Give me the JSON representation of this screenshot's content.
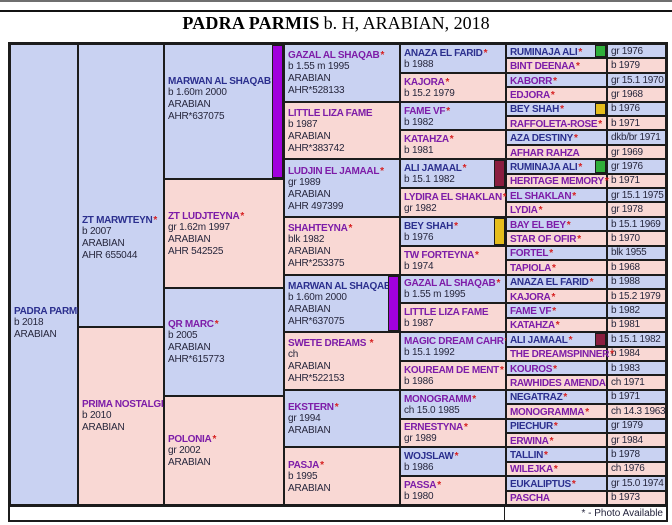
{
  "title": {
    "name": "PADRA PARMIS",
    "details": "b. H, ARABIAN, 2018"
  },
  "footer_note": "* - Photo Available",
  "star_char": "*",
  "colors": {
    "lavender": "#c9d2f2",
    "pink": "#f9d8d4",
    "link_blue": "#2b2f8e",
    "link_purple": "#7d1ca8",
    "star_red": "#d62020",
    "detail_text": "#26263c",
    "grid": "#1c1c1c",
    "ribbon_purple": "#a100dd",
    "ribbon_maroon": "#8a1e3f",
    "ribbon_yellow": "#e5bd1c",
    "ribbon_green": "#2fae3a"
  },
  "pedigree": {
    "gen1": [
      {
        "name": "PADRA PARMIS",
        "star": false,
        "link": "blue",
        "lines": [
          "b 2018",
          "ARABIAN"
        ],
        "ribbon": null
      }
    ],
    "gen2": [
      {
        "name": "ZT MARWTEYN",
        "star": true,
        "link": "blue",
        "lines": [
          "b 2007",
          "ARABIAN",
          "AHR 655044"
        ],
        "ribbon": null
      },
      {
        "name": "PRIMA NOSTALGIA",
        "star": false,
        "link": "purple",
        "lines": [
          "b 2010",
          "ARABIAN"
        ],
        "ribbon": null
      }
    ],
    "gen3": [
      {
        "name": "MARWAN AL SHAQAB",
        "star": true,
        "link": "blue",
        "lines": [
          "b 1.60m 2000",
          "ARABIAN",
          "AHR*637075"
        ],
        "ribbon": "purple"
      },
      {
        "name": "ZT LUDJTEYNA",
        "star": true,
        "link": "purple",
        "lines": [
          "gr 1.62m 1997",
          "ARABIAN",
          "AHR 542525"
        ],
        "ribbon": null
      },
      {
        "name": "QR MARC",
        "star": true,
        "link": "purple",
        "lines": [
          "b 2005",
          "ARABIAN",
          "AHR*615773"
        ],
        "ribbon": null
      },
      {
        "name": "POLONIA",
        "star": true,
        "link": "purple",
        "lines": [
          "gr 2002",
          "ARABIAN"
        ],
        "ribbon": null
      }
    ],
    "gen4": [
      {
        "name": "GAZAL AL SHAQAB",
        "star": true,
        "link": "purple",
        "lines": [
          "b 1.55 m 1995",
          "ARABIAN",
          "AHR*528133"
        ],
        "ribbon": null
      },
      {
        "name": "LITTLE LIZA FAME",
        "star": false,
        "link": "purple",
        "lines": [
          "b 1987",
          "ARABIAN",
          "AHR*383742"
        ],
        "ribbon": null
      },
      {
        "name": "LUDJIN EL JAMAAL",
        "star": true,
        "link": "purple",
        "lines": [
          "gr 1989",
          "ARABIAN",
          "AHR 497399"
        ],
        "ribbon": null
      },
      {
        "name": "SHAHTEYNA",
        "star": true,
        "link": "purple",
        "lines": [
          "blk 1982",
          "ARABIAN",
          "AHR*253375"
        ],
        "ribbon": null
      },
      {
        "name": "MARWAN AL SHAQAB",
        "star": true,
        "link": "blue",
        "lines": [
          "b 1.60m 2000",
          "ARABIAN",
          "AHR*637075"
        ],
        "ribbon": "purple"
      },
      {
        "name": "SWETE DREAMS ",
        "star": true,
        "link": "purple",
        "lines": [
          "ch",
          "ARABIAN",
          "AHR*522153"
        ],
        "ribbon": null
      },
      {
        "name": "EKSTERN",
        "star": true,
        "link": "purple",
        "lines": [
          "gr 1994",
          "ARABIAN"
        ],
        "ribbon": null
      },
      {
        "name": "PASJA",
        "star": true,
        "link": "purple",
        "lines": [
          "b 1995",
          "ARABIAN"
        ],
        "ribbon": null
      }
    ],
    "gen5": [
      {
        "name": "ANAZA EL FARID",
        "star": true,
        "link": "blue",
        "lines": [
          "b 1988"
        ],
        "ribbon": null
      },
      {
        "name": "KAJORA",
        "star": true,
        "link": "purple",
        "lines": [
          "b 15.2 1979"
        ],
        "ribbon": null
      },
      {
        "name": "FAME VF",
        "star": true,
        "link": "purple",
        "lines": [
          "b 1982"
        ],
        "ribbon": null
      },
      {
        "name": "KATAHZA",
        "star": true,
        "link": "purple",
        "lines": [
          "b 1981"
        ],
        "ribbon": null
      },
      {
        "name": "ALI JAMAAL",
        "star": true,
        "link": "blue",
        "lines": [
          "b 15.1 1982"
        ],
        "ribbon": "maroon"
      },
      {
        "name": "LYDIRA EL SHAKLAN",
        "star": true,
        "link": "purple",
        "lines": [
          "gr 1982"
        ],
        "ribbon": null
      },
      {
        "name": "BEY SHAH",
        "star": true,
        "link": "blue",
        "lines": [
          "b 1976"
        ],
        "ribbon": "yellow"
      },
      {
        "name": "TW FORTEYNA",
        "star": true,
        "link": "purple",
        "lines": [
          "b 1974"
        ],
        "ribbon": null
      },
      {
        "name": "GAZAL AL SHAQAB",
        "star": true,
        "link": "purple",
        "lines": [
          "b 1.55 m 1995"
        ],
        "ribbon": null
      },
      {
        "name": "LITTLE LIZA FAME",
        "star": false,
        "link": "purple",
        "lines": [
          "b 1987"
        ],
        "ribbon": null
      },
      {
        "name": "MAGIC DREAM CAHR",
        "star": true,
        "link": "purple",
        "lines": [
          "b 15.1 1992"
        ],
        "ribbon": null
      },
      {
        "name": "KOUREAM DE MENT",
        "star": true,
        "link": "purple",
        "lines": [
          "b 1986"
        ],
        "ribbon": null
      },
      {
        "name": "MONOGRAMM",
        "star": true,
        "link": "purple",
        "lines": [
          "ch 15.0 1985"
        ],
        "ribbon": null
      },
      {
        "name": "ERNESTYNA",
        "star": true,
        "link": "purple",
        "lines": [
          "gr 1989"
        ],
        "ribbon": null
      },
      {
        "name": "WOJSLAW",
        "star": true,
        "link": "blue",
        "lines": [
          "b 1986"
        ],
        "ribbon": null
      },
      {
        "name": "PASSA",
        "star": true,
        "link": "purple",
        "lines": [
          "b 1980"
        ],
        "ribbon": null
      }
    ],
    "gen6": [
      {
        "name": "RUMINAJA ALI",
        "star": true,
        "link": "blue",
        "swatch": "green",
        "year": "gr 1976"
      },
      {
        "name": "BINT DEENAA",
        "star": true,
        "link": "purple",
        "swatch": null,
        "year": "b 1979"
      },
      {
        "name": "KABORR",
        "star": true,
        "link": "purple",
        "swatch": null,
        "year": "gr 15.1 1970"
      },
      {
        "name": "EDJORA",
        "star": true,
        "link": "purple",
        "swatch": null,
        "year": "gr 1968"
      },
      {
        "name": "BEY SHAH",
        "star": true,
        "link": "blue",
        "swatch": "yellow",
        "year": "b 1976"
      },
      {
        "name": "RAFFOLETA-ROSE",
        "star": true,
        "link": "purple",
        "swatch": null,
        "year": "b 1971"
      },
      {
        "name": "AZA DESTINY",
        "star": true,
        "link": "blue",
        "swatch": null,
        "year": "dkb/br 1971"
      },
      {
        "name": "AFHAR RAHZA",
        "star": false,
        "link": "purple",
        "swatch": null,
        "year": "gr 1969"
      },
      {
        "name": "RUMINAJA ALI",
        "star": true,
        "link": "blue",
        "swatch": "green",
        "year": "gr 1976"
      },
      {
        "name": "HERITAGE MEMORY",
        "star": true,
        "link": "purple",
        "swatch": null,
        "year": "b 1971"
      },
      {
        "name": "EL SHAKLAN",
        "star": true,
        "link": "purple",
        "swatch": null,
        "year": "gr 15.1 1975"
      },
      {
        "name": "LYDIA",
        "star": true,
        "link": "purple",
        "swatch": null,
        "year": "gr 1978"
      },
      {
        "name": "BAY EL BEY",
        "star": true,
        "link": "purple",
        "swatch": null,
        "year": "b 15.1 1969"
      },
      {
        "name": "STAR OF OFIR",
        "star": true,
        "link": "purple",
        "swatch": null,
        "year": "b 1970"
      },
      {
        "name": "FORTEL",
        "star": true,
        "link": "purple",
        "swatch": null,
        "year": "blk 1955"
      },
      {
        "name": "TAPIOLA",
        "star": true,
        "link": "purple",
        "swatch": null,
        "year": "b 1968"
      },
      {
        "name": "ANAZA EL FARID",
        "star": true,
        "link": "blue",
        "swatch": null,
        "year": "b 1988"
      },
      {
        "name": "KAJORA",
        "star": true,
        "link": "purple",
        "swatch": null,
        "year": "b 15.2 1979"
      },
      {
        "name": "FAME VF",
        "star": true,
        "link": "purple",
        "swatch": null,
        "year": "b 1982"
      },
      {
        "name": "KATAHZA",
        "star": true,
        "link": "purple",
        "swatch": null,
        "year": "b 1981"
      },
      {
        "name": "ALI JAMAAL",
        "star": true,
        "link": "blue",
        "swatch": "maroon",
        "year": "b 15.1 1982"
      },
      {
        "name": "THE DREAMSPINNER",
        "star": true,
        "link": "purple",
        "swatch": null,
        "year": "b 1984"
      },
      {
        "name": "KOUROS",
        "star": true,
        "link": "purple",
        "swatch": null,
        "year": "b 1983"
      },
      {
        "name": "RAWHIDES AMENDA",
        "star": false,
        "link": "purple",
        "swatch": null,
        "year": "ch 1971"
      },
      {
        "name": "NEGATRAZ",
        "star": true,
        "link": "blue",
        "swatch": null,
        "year": "b 1971"
      },
      {
        "name": "MONOGRAMMA",
        "star": true,
        "link": "purple",
        "swatch": null,
        "year": "ch 14.3 1963"
      },
      {
        "name": "PIECHUR",
        "star": true,
        "link": "blue",
        "swatch": null,
        "year": "gr 1979"
      },
      {
        "name": "ERWINA",
        "star": true,
        "link": "purple",
        "swatch": null,
        "year": "gr 1984"
      },
      {
        "name": "TALLIN",
        "star": true,
        "link": "blue",
        "swatch": null,
        "year": "b 1978"
      },
      {
        "name": "WILEJKA",
        "star": true,
        "link": "purple",
        "swatch": null,
        "year": "ch 1976"
      },
      {
        "name": "EUKALIPTUS",
        "star": true,
        "link": "blue",
        "swatch": null,
        "year": "gr 15.0 1974"
      },
      {
        "name": "PASCHA",
        "star": false,
        "link": "purple",
        "swatch": null,
        "year": "b 1973"
      }
    ]
  }
}
